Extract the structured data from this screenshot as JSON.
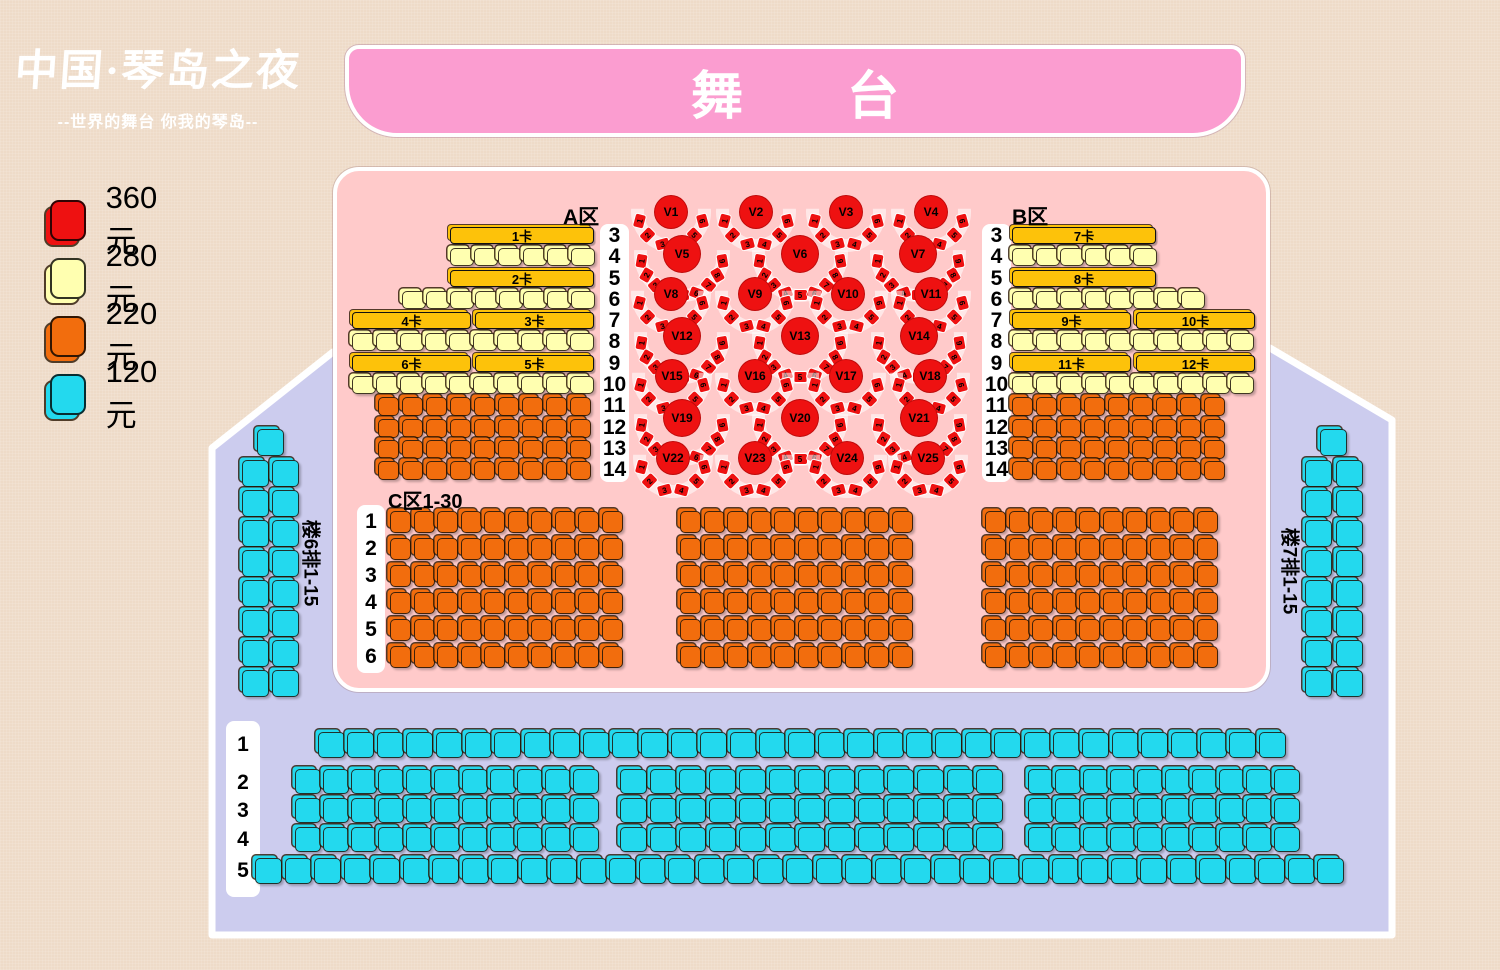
{
  "title": "中国·琴岛之夜 剧场座位图",
  "colors": {
    "bg": "#eedbc8",
    "lavender": "#ccccee",
    "pink": "#ffcaca",
    "stagepink": "#fb9dd0",
    "red": "#ee1111",
    "yellow": "#ffffb0",
    "orange": "#f26d0d",
    "cyan": "#23d9ee",
    "gold": "#fdc20a",
    "white": "#ffffff"
  },
  "logo": {
    "main": "中国·琴岛之夜",
    "tagline": "--世界的舞台 你我的琴岛--"
  },
  "stage": {
    "label": "舞台"
  },
  "legend": [
    {
      "price": "360元",
      "color_key": "red"
    },
    {
      "price": "280元",
      "color_key": "yellow"
    },
    {
      "price": "220元",
      "color_key": "orange"
    },
    {
      "price": "120元",
      "color_key": "cyan"
    }
  ],
  "sections": {
    "a_label": "A区",
    "b_label": "B区",
    "c_label": "C区1-30",
    "left_balcony_label": "楼6排1-15",
    "right_balcony_label": "楼7排1-15"
  },
  "booth_bars": [
    {
      "t": "1卡",
      "x": 450,
      "y": 227,
      "w": 144
    },
    {
      "t": "2卡",
      "x": 450,
      "y": 270,
      "w": 144
    },
    {
      "t": "4卡",
      "x": 352,
      "y": 312,
      "w": 119
    },
    {
      "t": "3卡",
      "x": 475,
      "y": 312,
      "w": 119
    },
    {
      "t": "6卡",
      "x": 352,
      "y": 355,
      "w": 119
    },
    {
      "t": "5卡",
      "x": 475,
      "y": 355,
      "w": 119
    },
    {
      "t": "7卡",
      "x": 1012,
      "y": 227,
      "w": 144
    },
    {
      "t": "8卡",
      "x": 1012,
      "y": 270,
      "w": 144
    },
    {
      "t": "9卡",
      "x": 1012,
      "y": 312,
      "w": 119
    },
    {
      "t": "10卡",
      "x": 1136,
      "y": 312,
      "w": 119
    },
    {
      "t": "11卡",
      "x": 1012,
      "y": 355,
      "w": 119
    },
    {
      "t": "12卡",
      "x": 1136,
      "y": 355,
      "w": 119
    }
  ],
  "number_strips": [
    {
      "x": 600,
      "y": 224,
      "w": 29,
      "h": 258,
      "labels": [
        "3",
        "4",
        "5",
        "6",
        "7",
        "8",
        "9",
        "10",
        "11",
        "12",
        "13",
        "14"
      ],
      "cys": [
        236,
        257,
        279,
        300,
        321,
        342,
        364,
        385,
        406,
        428,
        449,
        470
      ]
    },
    {
      "x": 982,
      "y": 224,
      "w": 29,
      "h": 258,
      "labels": [
        "3",
        "4",
        "5",
        "6",
        "7",
        "8",
        "9",
        "10",
        "11",
        "12",
        "13",
        "14"
      ],
      "cys": [
        236,
        257,
        279,
        300,
        321,
        342,
        364,
        385,
        406,
        428,
        449,
        470
      ]
    },
    {
      "x": 357,
      "y": 505,
      "w": 28,
      "h": 168,
      "labels": [
        "1",
        "2",
        "3",
        "4",
        "5",
        "6"
      ],
      "cys": [
        522,
        549,
        576,
        603,
        630,
        657
      ]
    },
    {
      "x": 226,
      "y": 721,
      "w": 34,
      "h": 176,
      "labels": [
        "1",
        "2",
        "3",
        "4",
        "5"
      ],
      "cys": [
        745,
        783,
        811,
        840,
        871
      ]
    }
  ],
  "seat_rows": [
    {
      "x": 450,
      "y": 248,
      "n": 6,
      "w": 24,
      "h": 18,
      "p": 24.2,
      "c": "yellow"
    },
    {
      "x": 402,
      "y": 291,
      "n": 8,
      "w": 24,
      "h": 18,
      "p": 24.2,
      "c": "yellow"
    },
    {
      "x": 352,
      "y": 333,
      "n": 10,
      "w": 24,
      "h": 18,
      "p": 24.2,
      "c": "yellow"
    },
    {
      "x": 352,
      "y": 376,
      "n": 10,
      "w": 24,
      "h": 18,
      "p": 24.2,
      "c": "yellow"
    },
    {
      "x": 378,
      "y": 397,
      "n": 9,
      "w": 21,
      "h": 19,
      "p": 24,
      "c": "orange"
    },
    {
      "x": 378,
      "y": 419,
      "n": 9,
      "w": 21,
      "h": 19,
      "p": 24,
      "c": "orange"
    },
    {
      "x": 378,
      "y": 440,
      "n": 9,
      "w": 21,
      "h": 19,
      "p": 24,
      "c": "orange"
    },
    {
      "x": 378,
      "y": 461,
      "n": 9,
      "w": 21,
      "h": 19,
      "p": 24,
      "c": "orange"
    },
    {
      "x": 1012,
      "y": 248,
      "n": 6,
      "w": 24,
      "h": 18,
      "p": 24.2,
      "c": "yellow"
    },
    {
      "x": 1012,
      "y": 291,
      "n": 8,
      "w": 24,
      "h": 18,
      "p": 24.2,
      "c": "yellow"
    },
    {
      "x": 1012,
      "y": 333,
      "n": 10,
      "w": 24,
      "h": 18,
      "p": 24.2,
      "c": "yellow"
    },
    {
      "x": 1012,
      "y": 376,
      "n": 10,
      "w": 24,
      "h": 18,
      "p": 24.2,
      "c": "yellow"
    },
    {
      "x": 1012,
      "y": 397,
      "n": 9,
      "w": 21,
      "h": 19,
      "p": 24,
      "c": "orange"
    },
    {
      "x": 1012,
      "y": 419,
      "n": 9,
      "w": 21,
      "h": 19,
      "p": 24,
      "c": "orange"
    },
    {
      "x": 1012,
      "y": 440,
      "n": 9,
      "w": 21,
      "h": 19,
      "p": 24,
      "c": "orange"
    },
    {
      "x": 1012,
      "y": 461,
      "n": 9,
      "w": 21,
      "h": 19,
      "p": 24,
      "c": "orange"
    },
    {
      "x": 390,
      "y": 511,
      "n": 10,
      "w": 21,
      "h": 22,
      "p": 23.5,
      "c": "orange"
    },
    {
      "x": 390,
      "y": 538,
      "n": 10,
      "w": 21,
      "h": 22,
      "p": 23.5,
      "c": "orange"
    },
    {
      "x": 390,
      "y": 565,
      "n": 10,
      "w": 21,
      "h": 22,
      "p": 23.5,
      "c": "orange"
    },
    {
      "x": 390,
      "y": 592,
      "n": 10,
      "w": 21,
      "h": 22,
      "p": 23.5,
      "c": "orange"
    },
    {
      "x": 390,
      "y": 619,
      "n": 10,
      "w": 21,
      "h": 22,
      "p": 23.5,
      "c": "orange"
    },
    {
      "x": 390,
      "y": 646,
      "n": 10,
      "w": 21,
      "h": 22,
      "p": 23.5,
      "c": "orange"
    },
    {
      "x": 680,
      "y": 511,
      "n": 10,
      "w": 21,
      "h": 22,
      "p": 23.5,
      "c": "orange"
    },
    {
      "x": 680,
      "y": 538,
      "n": 10,
      "w": 21,
      "h": 22,
      "p": 23.5,
      "c": "orange"
    },
    {
      "x": 680,
      "y": 565,
      "n": 10,
      "w": 21,
      "h": 22,
      "p": 23.5,
      "c": "orange"
    },
    {
      "x": 680,
      "y": 592,
      "n": 10,
      "w": 21,
      "h": 22,
      "p": 23.5,
      "c": "orange"
    },
    {
      "x": 680,
      "y": 619,
      "n": 10,
      "w": 21,
      "h": 22,
      "p": 23.5,
      "c": "orange"
    },
    {
      "x": 680,
      "y": 646,
      "n": 10,
      "w": 21,
      "h": 22,
      "p": 23.5,
      "c": "orange"
    },
    {
      "x": 985,
      "y": 511,
      "n": 10,
      "w": 21,
      "h": 22,
      "p": 23.5,
      "c": "orange"
    },
    {
      "x": 985,
      "y": 538,
      "n": 10,
      "w": 21,
      "h": 22,
      "p": 23.5,
      "c": "orange"
    },
    {
      "x": 985,
      "y": 565,
      "n": 10,
      "w": 21,
      "h": 22,
      "p": 23.5,
      "c": "orange"
    },
    {
      "x": 985,
      "y": 592,
      "n": 10,
      "w": 21,
      "h": 22,
      "p": 23.5,
      "c": "orange"
    },
    {
      "x": 985,
      "y": 619,
      "n": 10,
      "w": 21,
      "h": 22,
      "p": 23.5,
      "c": "orange"
    },
    {
      "x": 985,
      "y": 646,
      "n": 10,
      "w": 21,
      "h": 22,
      "p": 23.5,
      "c": "orange"
    },
    {
      "x": 318,
      "y": 732,
      "n": 33,
      "w": 27,
      "h": 26,
      "p": 29.4,
      "c": "cyan"
    },
    {
      "x": 295,
      "y": 769,
      "n": 11,
      "w": 26,
      "h": 25,
      "p": 27.8,
      "c": "cyan"
    },
    {
      "x": 620,
      "y": 769,
      "n": 13,
      "w": 27,
      "h": 25,
      "p": 29.7,
      "c": "cyan"
    },
    {
      "x": 1028,
      "y": 769,
      "n": 10,
      "w": 26,
      "h": 25,
      "p": 27.3,
      "c": "cyan"
    },
    {
      "x": 295,
      "y": 798,
      "n": 11,
      "w": 26,
      "h": 25,
      "p": 27.8,
      "c": "cyan"
    },
    {
      "x": 620,
      "y": 798,
      "n": 13,
      "w": 27,
      "h": 25,
      "p": 29.7,
      "c": "cyan"
    },
    {
      "x": 1028,
      "y": 798,
      "n": 10,
      "w": 26,
      "h": 25,
      "p": 27.3,
      "c": "cyan"
    },
    {
      "x": 295,
      "y": 827,
      "n": 11,
      "w": 26,
      "h": 25,
      "p": 27.8,
      "c": "cyan"
    },
    {
      "x": 620,
      "y": 827,
      "n": 13,
      "w": 27,
      "h": 25,
      "p": 29.7,
      "c": "cyan"
    },
    {
      "x": 1028,
      "y": 827,
      "n": 10,
      "w": 26,
      "h": 25,
      "p": 27.3,
      "c": "cyan"
    },
    {
      "x": 255,
      "y": 858,
      "n": 37,
      "w": 27,
      "h": 26,
      "p": 29.5,
      "c": "cyan"
    },
    {
      "x": 257,
      "y": 429,
      "n": 1,
      "w": 27,
      "h": 27,
      "p": 30,
      "c": "cyan"
    },
    {
      "x": 242,
      "y": 460,
      "n": 2,
      "w": 27,
      "h": 27,
      "p": 30,
      "c": "cyan"
    },
    {
      "x": 242,
      "y": 490,
      "n": 2,
      "w": 27,
      "h": 27,
      "p": 30,
      "c": "cyan"
    },
    {
      "x": 242,
      "y": 520,
      "n": 2,
      "w": 27,
      "h": 27,
      "p": 30,
      "c": "cyan"
    },
    {
      "x": 242,
      "y": 550,
      "n": 2,
      "w": 27,
      "h": 27,
      "p": 30,
      "c": "cyan"
    },
    {
      "x": 242,
      "y": 580,
      "n": 2,
      "w": 27,
      "h": 27,
      "p": 30,
      "c": "cyan"
    },
    {
      "x": 242,
      "y": 610,
      "n": 2,
      "w": 27,
      "h": 27,
      "p": 30,
      "c": "cyan"
    },
    {
      "x": 242,
      "y": 640,
      "n": 2,
      "w": 27,
      "h": 27,
      "p": 30,
      "c": "cyan"
    },
    {
      "x": 242,
      "y": 670,
      "n": 2,
      "w": 27,
      "h": 27,
      "p": 30,
      "c": "cyan"
    },
    {
      "x": 1320,
      "y": 429,
      "n": 1,
      "w": 27,
      "h": 27,
      "p": 31,
      "c": "cyan"
    },
    {
      "x": 1305,
      "y": 460,
      "n": 2,
      "w": 27,
      "h": 27,
      "p": 31,
      "c": "cyan"
    },
    {
      "x": 1305,
      "y": 490,
      "n": 2,
      "w": 27,
      "h": 27,
      "p": 31,
      "c": "cyan"
    },
    {
      "x": 1305,
      "y": 520,
      "n": 2,
      "w": 27,
      "h": 27,
      "p": 31,
      "c": "cyan"
    },
    {
      "x": 1305,
      "y": 550,
      "n": 2,
      "w": 27,
      "h": 27,
      "p": 31,
      "c": "cyan"
    },
    {
      "x": 1305,
      "y": 580,
      "n": 2,
      "w": 27,
      "h": 27,
      "p": 31,
      "c": "cyan"
    },
    {
      "x": 1305,
      "y": 610,
      "n": 2,
      "w": 27,
      "h": 27,
      "p": 31,
      "c": "cyan"
    },
    {
      "x": 1305,
      "y": 640,
      "n": 2,
      "w": 27,
      "h": 27,
      "p": 31,
      "c": "cyan"
    },
    {
      "x": 1305,
      "y": 670,
      "n": 2,
      "w": 27,
      "h": 27,
      "p": 31,
      "c": "cyan"
    }
  ],
  "vip_tables": [
    {
      "l": "V1",
      "x": 671,
      "y": 212,
      "n": 6,
      "r": 33,
      "cd": 34
    },
    {
      "l": "V2",
      "x": 756,
      "y": 212,
      "n": 6,
      "r": 33,
      "cd": 34
    },
    {
      "l": "V3",
      "x": 846,
      "y": 212,
      "n": 6,
      "r": 33,
      "cd": 34
    },
    {
      "l": "V4",
      "x": 931,
      "y": 212,
      "n": 6,
      "r": 33,
      "cd": 34
    },
    {
      "l": "V5",
      "x": 682,
      "y": 254,
      "n": 9,
      "r": 41,
      "cd": 38
    },
    {
      "l": "V6",
      "x": 800,
      "y": 254,
      "n": 9,
      "r": 41,
      "cd": 38
    },
    {
      "l": "V7",
      "x": 918,
      "y": 254,
      "n": 9,
      "r": 41,
      "cd": 38
    },
    {
      "l": "V8",
      "x": 671,
      "y": 294,
      "n": 6,
      "r": 33,
      "cd": 34
    },
    {
      "l": "V9",
      "x": 755,
      "y": 294,
      "n": 6,
      "r": 33,
      "cd": 34
    },
    {
      "l": "V10",
      "x": 848,
      "y": 294,
      "n": 6,
      "r": 33,
      "cd": 34
    },
    {
      "l": "V11",
      "x": 931,
      "y": 294,
      "n": 6,
      "r": 33,
      "cd": 34
    },
    {
      "l": "V12",
      "x": 682,
      "y": 336,
      "n": 9,
      "r": 41,
      "cd": 38
    },
    {
      "l": "V13",
      "x": 800,
      "y": 336,
      "n": 9,
      "r": 41,
      "cd": 38
    },
    {
      "l": "V14",
      "x": 919,
      "y": 336,
      "n": 9,
      "r": 41,
      "cd": 38
    },
    {
      "l": "V15",
      "x": 672,
      "y": 376,
      "n": 6,
      "r": 33,
      "cd": 34
    },
    {
      "l": "V16",
      "x": 755,
      "y": 376,
      "n": 6,
      "r": 33,
      "cd": 34
    },
    {
      "l": "V17",
      "x": 846,
      "y": 376,
      "n": 6,
      "r": 33,
      "cd": 34
    },
    {
      "l": "V18",
      "x": 930,
      "y": 376,
      "n": 6,
      "r": 33,
      "cd": 34
    },
    {
      "l": "V19",
      "x": 682,
      "y": 418,
      "n": 9,
      "r": 41,
      "cd": 38
    },
    {
      "l": "V20",
      "x": 800,
      "y": 418,
      "n": 9,
      "r": 41,
      "cd": 38
    },
    {
      "l": "V21",
      "x": 919,
      "y": 418,
      "n": 9,
      "r": 41,
      "cd": 38
    },
    {
      "l": "V22",
      "x": 673,
      "y": 458,
      "n": 6,
      "r": 33,
      "cd": 34
    },
    {
      "l": "V23",
      "x": 755,
      "y": 458,
      "n": 6,
      "r": 33,
      "cd": 34
    },
    {
      "l": "V24",
      "x": 847,
      "y": 458,
      "n": 6,
      "r": 33,
      "cd": 34
    },
    {
      "l": "V25",
      "x": 928,
      "y": 458,
      "n": 6,
      "r": 33,
      "cd": 34
    }
  ],
  "section_label_pos": {
    "a": {
      "x": 563,
      "y": 201
    },
    "b": {
      "x": 1012,
      "y": 201
    },
    "c": {
      "x": 388,
      "y": 485
    },
    "left_balcony": {
      "x": 312,
      "y": 563
    },
    "right_balcony": {
      "x": 1291,
      "y": 571
    }
  }
}
